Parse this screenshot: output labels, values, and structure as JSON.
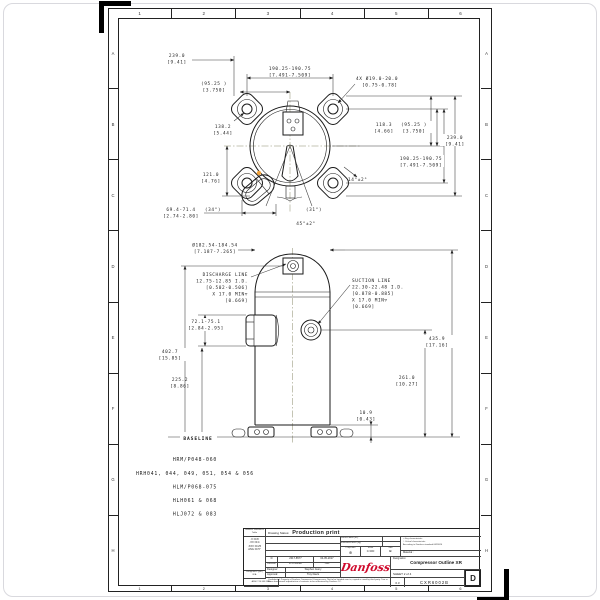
{
  "sheet": {
    "zones_cols": [
      "1",
      "2",
      "3",
      "4",
      "5",
      "6"
    ],
    "zones_rows": [
      "A",
      "B",
      "C",
      "D",
      "E",
      "F",
      "G",
      "H"
    ]
  },
  "colors": {
    "accent_orange": "#f2a33c",
    "logo_red": "#cf0a2c"
  },
  "top_view": {
    "overall_mm": "239.0",
    "overall_in": "[9.41]",
    "bolt_span_mm": "190.25-190.75",
    "bolt_span_in": "[7.491-7.509]",
    "half_span_mm": "(95.25 )",
    "half_span_in": "[3.750]",
    "holes_mm": "4X Ø19.0-20.0",
    "holes_in": "[0.75-0.78]",
    "diag_mm": "138.2",
    "diag_in": "[5.44]",
    "side_mm": "118.3",
    "side_in": "[4.66]",
    "lower_mm": "121.0",
    "lower_in": "[4.76]",
    "glass_mm": "69.4-71.4",
    "glass_in": "[2.74-2.80]",
    "angle_34": "(34°)",
    "angle_31": "(31°)",
    "angle_45": "45°±2°",
    "angle_14": "14°±2°"
  },
  "side_view": {
    "shell_dia_mm": "Ø182.54-184.54",
    "shell_dia_in": "[7.187-7.265]",
    "discharge_lines": [
      "DISCHARGE LINE",
      "12.75-12.85 I.D.",
      "[0.502-0.506]",
      "X 17.0 MIN▽",
      "[0.669]"
    ],
    "suction_lines": [
      "SUCTION LINE",
      "22.30-22.48 I.D.",
      "[0.878-0.885]",
      "X 17.0 MIN▽",
      "[0.669]"
    ],
    "h402_mm": "402.7",
    "h402_in": "[15.85]",
    "h225_mm": "225.2",
    "h225_in": "[8.86]",
    "h72_mm": "72.1-75.1",
    "h72_in": "[2.84-2.95]",
    "h435_mm": "435.9",
    "h435_in": "[17.16]",
    "h261_mm": "261.0",
    "h261_in": "[10.27]",
    "h10_mm": "10.9",
    "h10_in": "[0.43]",
    "baseline_label": "BASELINE"
  },
  "models": [
    "HRM/P048-060",
    "HRH041, 044, 049, 051, 054 & 056",
    "HLM/P068-075",
    "HLH061 & 068",
    "HLJ072 & 083"
  ],
  "title_block": {
    "tolerance_table": {
      "header": "General Tolerances Table",
      "rows": [
        ".X ±0.8",
        ".XX ±0.4",
        ".XXX ±0.25",
        "ANG ±0.5°"
      ],
      "roughness_label": "Roughness (µm)",
      "roughness_value": "N/A",
      "standard": "ANSI Y14.5M-1994"
    },
    "status_label": "Drawing Status:",
    "status_value": "Production print",
    "surface_area_label": "Surface Area (m²)",
    "estimated_mass_label": "Estimated Mass (kg)",
    "projection_label": "Projection",
    "projection_symbol": "⊕",
    "scale_label": "Scale",
    "scale_value": "0.300",
    "size_label": "Size",
    "size_value": "B",
    "key_symbol": "□",
    "key_characteristic": "Key characteristic:",
    "critical_symbol": "○",
    "critical_characteristic": "Critical characteristic:",
    "standard_note": "According to Danfoss standard 0623024",
    "material_label": "Material :",
    "revision_value": "D",
    "ecn_value": "2017-8577",
    "date_value": "04-05-2017",
    "revision_label": "Revision",
    "ecn_label": "ECN Number",
    "date_label": "Date",
    "designer_label": "Designer:",
    "designer_value": "Stephen Avery",
    "approval_label": "Approval:",
    "approval_value": "Troy Davis",
    "confidential_note": "Confidential: Property of Danfoss Commercial Compressors. Not to be handed over to, copied or used by third party. Two or three dimensional reproduction of contents to be authorized by Danfoss CC.",
    "logo_text": "Danfoss",
    "designation_label": "Designation",
    "designation_value": "Compressor Outline XR",
    "sheet_label": "SHEET 2 of 4",
    "scale_small": "0.3",
    "drawing_number": "CXR6002B",
    "sheet_size": "D"
  }
}
